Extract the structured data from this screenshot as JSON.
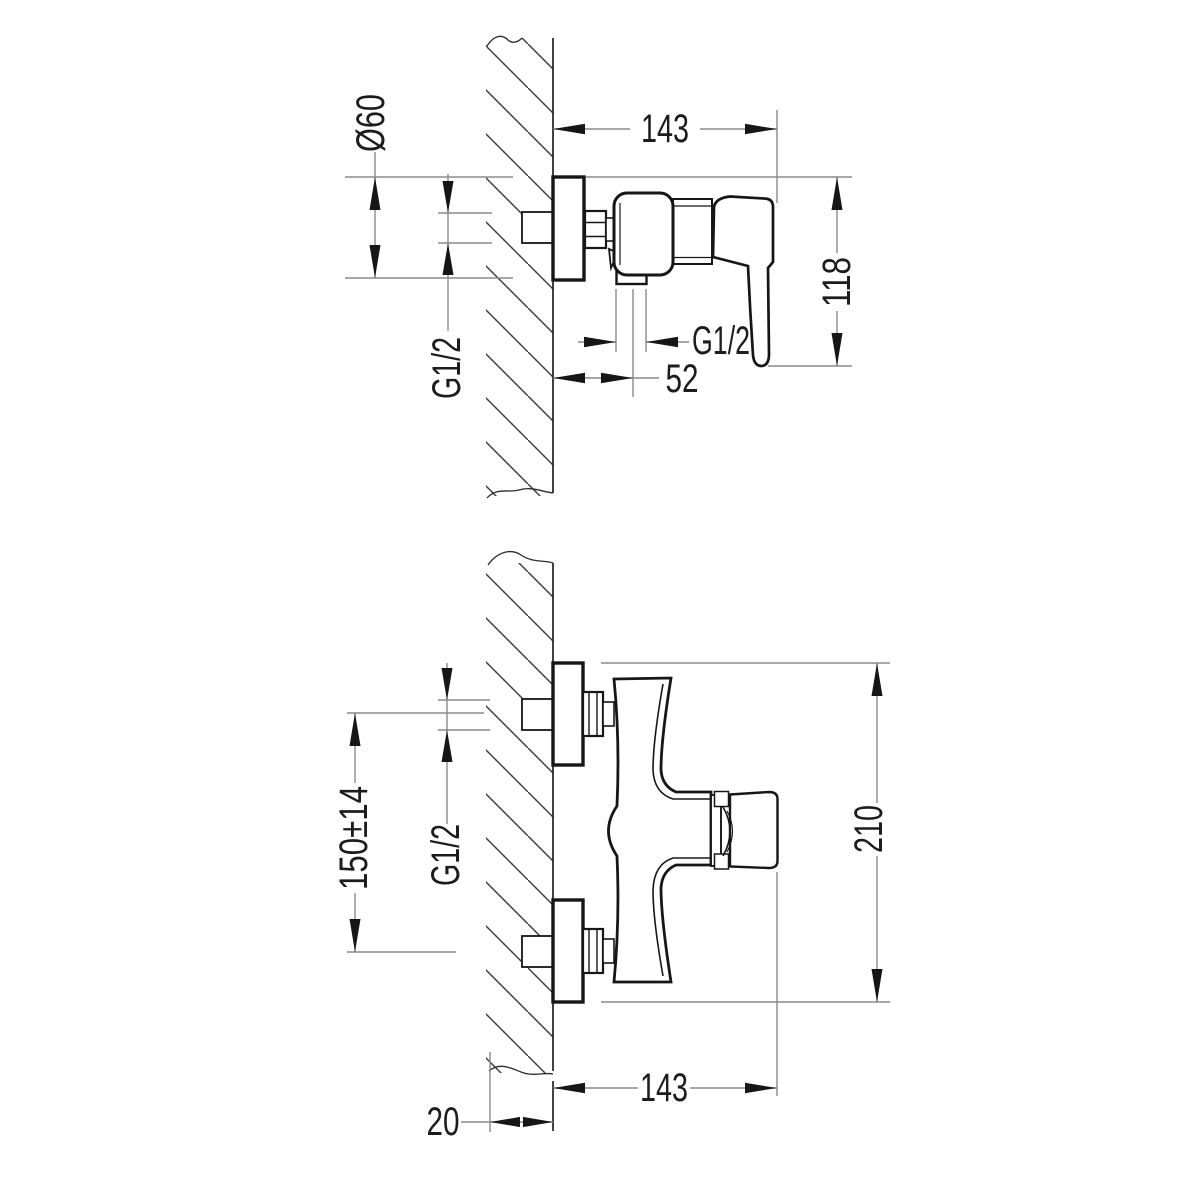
{
  "drawing": {
    "title": "Wall-mounted shower mixer installation drawing",
    "background_color": "#ffffff",
    "line_color": "#161616",
    "extension_line_color": "#8a8a8a",
    "views": {
      "side": {
        "name": "side view",
        "labels": {
          "flange_diameter": "Ø60",
          "overall_width": "143",
          "overall_height": "118",
          "inlet_thread": "G1/2",
          "outlet_thread": "G1/2",
          "outlet_offset": "52"
        }
      },
      "front": {
        "name": "front view",
        "labels": {
          "inlet_spacing": "150±14",
          "inlet_thread": "G1/2",
          "overall_height": "210",
          "overall_width": "143",
          "wall_thickness": "20"
        }
      }
    }
  }
}
